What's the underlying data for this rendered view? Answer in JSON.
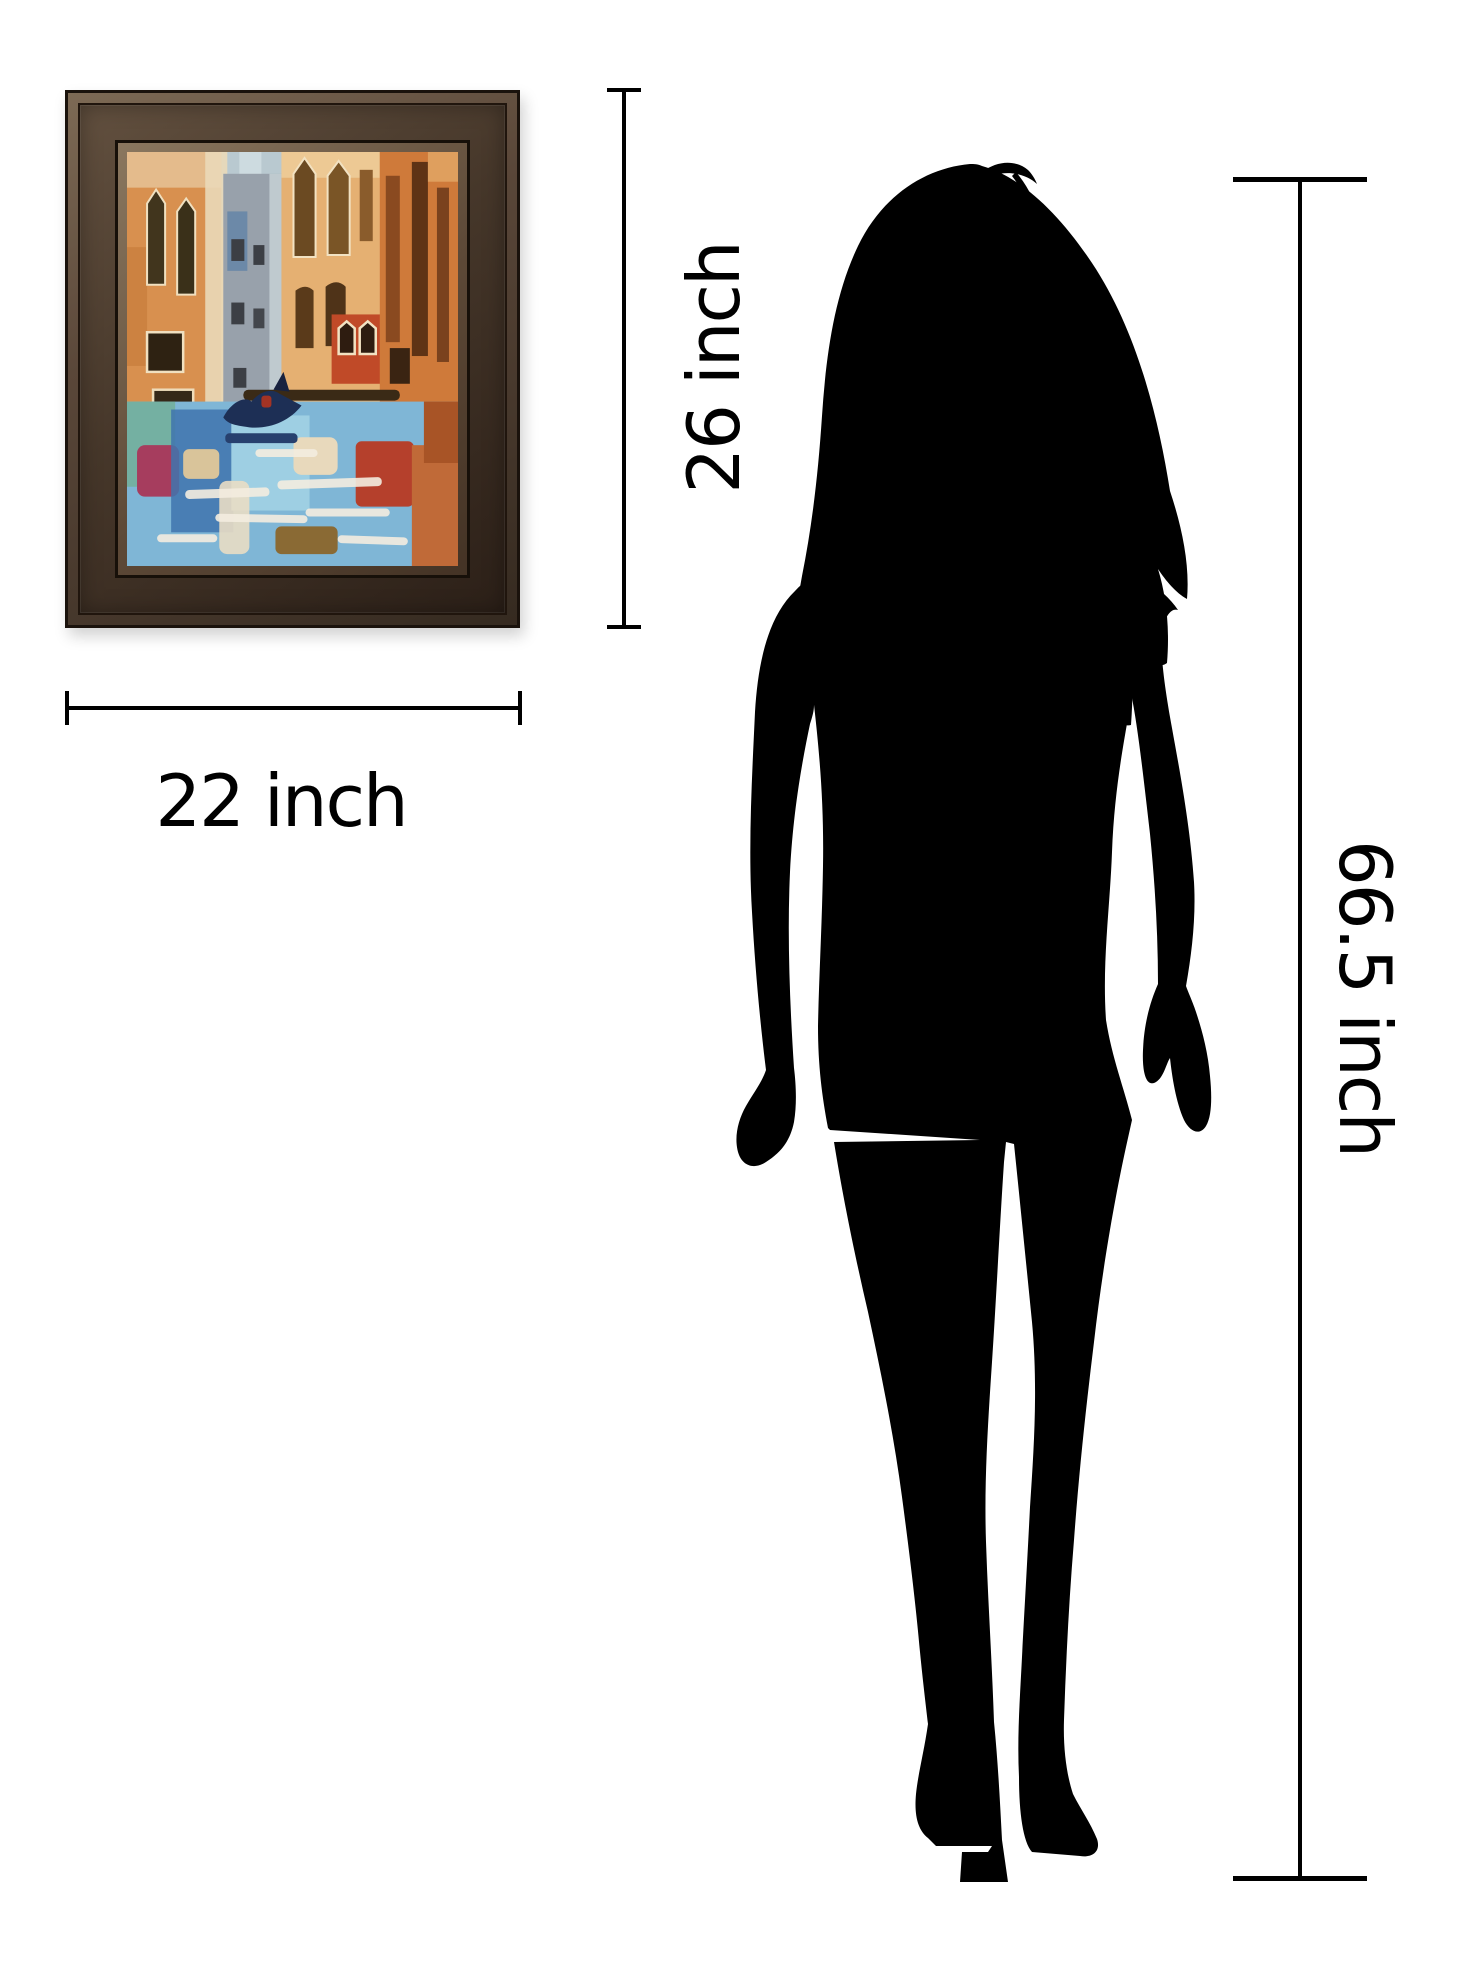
{
  "page": {
    "background_color": "#ffffff"
  },
  "artwork": {
    "title": "Framed Venice canal oil painting",
    "width_label": "22 inch",
    "height_label": "26 inch",
    "frame_color": "#41332a",
    "frame_inner_lip_color": "#8a775f",
    "palette": [
      "#d8904f",
      "#e5b072",
      "#98a1ab",
      "#b9c9d0",
      "#cf7a3a",
      "#c04a28",
      "#1d2f55",
      "#3f74ae",
      "#9ecfe3",
      "#74b0a2",
      "#a63d5e",
      "#b5402c",
      "#e8d9bc",
      "#3a2a16"
    ]
  },
  "person": {
    "title": "Woman silhouette for scale",
    "height_label": "66.5 inch",
    "silhouette_color": "#000000"
  },
  "dimensions": {
    "line_color": "#000000"
  }
}
